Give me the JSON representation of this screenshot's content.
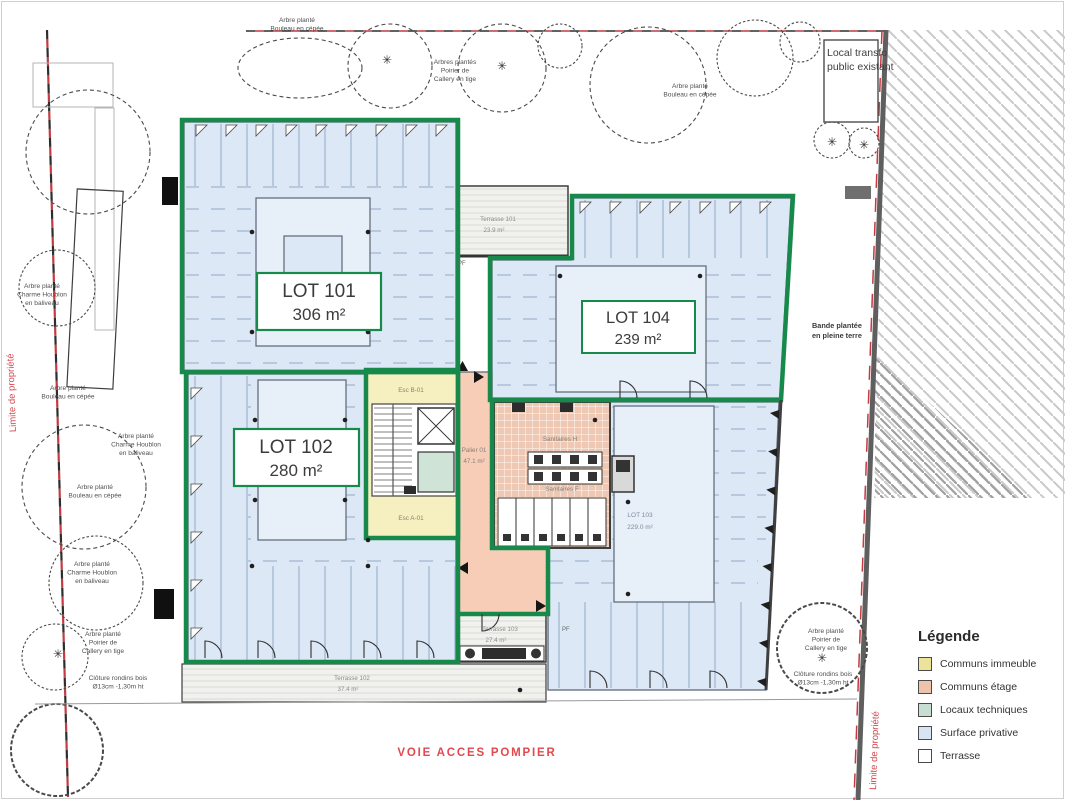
{
  "legend": {
    "title": "Légende",
    "items": [
      {
        "label": "Communs immeuble",
        "color": "#ece49b"
      },
      {
        "label": "Communs étage",
        "color": "#eec3ab"
      },
      {
        "label": "Locaux techniques",
        "color": "#c8ded2"
      },
      {
        "label": "Surface privative",
        "color": "#d7e4f2"
      },
      {
        "label": "Terrasse",
        "color": "#ffffff"
      }
    ]
  },
  "lots": {
    "l101": {
      "name": "LOT 101",
      "area": "306 m²"
    },
    "l102": {
      "name": "LOT 102",
      "area": "280 m²"
    },
    "l104": {
      "name": "LOT 104",
      "area": "239 m²"
    },
    "l103": {
      "name": "LOT 103",
      "area": "229.0 m²"
    }
  },
  "rooms": {
    "palier_name": "Palier 01",
    "palier_area": "47.1 m²",
    "esc_b": "Esc B-01",
    "esc_a": "Esc A-01",
    "san_h": "Sanitaires H",
    "san_f": "Sanitaires F",
    "pf": "PF"
  },
  "terraces": {
    "t101": {
      "name": "Terrasse 101",
      "area": "23.9 m²"
    },
    "t103": {
      "name": "Terrasse 103",
      "area": "27.4 m²"
    },
    "t102": {
      "name": "Terrasse 102",
      "area": "37.4 m²"
    }
  },
  "site": {
    "voie": "VOIE ACCES POMPIER",
    "limite": "Limite de propriété",
    "local_transfo_1": "Local transfo",
    "local_transfo_2": "public existant",
    "bande_1": "Bande plantée",
    "bande_2": "en pleine terre"
  },
  "tree_labels": [
    {
      "lines": [
        "Arbre planté",
        "Bouleau en cépée"
      ]
    },
    {
      "lines": [
        "Arbres plantés",
        "Poirier de",
        "Callery en tige"
      ]
    },
    {
      "lines": [
        "Arbre planté",
        "Bouleau en cépée"
      ]
    },
    {
      "lines": [
        "Arbre planté",
        "Charme Houblon",
        "en baliveau"
      ]
    },
    {
      "lines": [
        "Arbre planté",
        "Bouleau en cépée"
      ]
    },
    {
      "lines": [
        "Arbre planté",
        "Charme Houblon",
        "en baliveau"
      ]
    },
    {
      "lines": [
        "Arbre planté",
        "Bouleau en cépée"
      ]
    },
    {
      "lines": [
        "Arbre planté",
        "Charme Houblon",
        "en baliveau"
      ]
    },
    {
      "lines": [
        "Arbre planté",
        "Poirier de",
        "Callery en tige"
      ]
    },
    {
      "lines": [
        "Clôture rondins bois",
        "Ø13cm -1,30m ht"
      ]
    },
    {
      "lines": [
        "Arbre planté",
        "Poirier de",
        "Callery en tige"
      ]
    },
    {
      "lines": [
        "Clôture rondins bois",
        "Ø13cm -1,30m ht"
      ]
    }
  ],
  "colors": {
    "lot_outline_green": "#178a4b",
    "property_line_red": "#c43a40",
    "surface_privative": "#dce8f5",
    "communs_immeuble": "#f6efbf",
    "communs_etage": "#f7cdb8",
    "locaux_techniques": "#cfe3d6",
    "terrasse_fill": "#f1f1ee",
    "annotation_red": "#e2484e"
  }
}
